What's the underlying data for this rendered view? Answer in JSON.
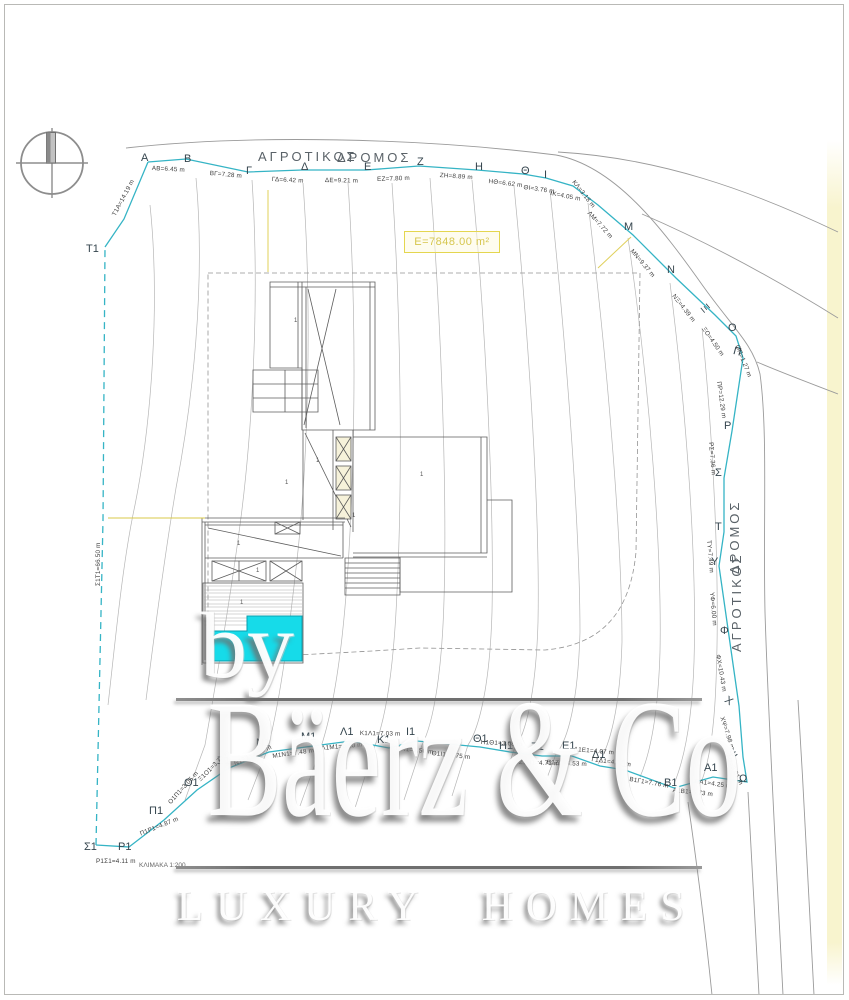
{
  "watermark": {
    "by": "by",
    "brand": "Bäerz & Co",
    "tagline": "LUXURY HOMES"
  },
  "plan": {
    "area_label": "Ε=7848.00 m²",
    "scale_label": "ΚΛΙΜΑΚΑ 1:200",
    "road_top": [
      "ΑΓΡΟΤΙΚΟΣ",
      "ΔΡΟΜΟΣ"
    ],
    "road_right": [
      "ΔΡΟΜΟΣ",
      "ΑΓΡΟΤΙΚΟΣ"
    ],
    "colors": {
      "boundary": "#35b4c5",
      "pool": "#16dbe9",
      "highlight": "#e0d05a",
      "contour": "#b3b3b3"
    },
    "points": [
      {
        "t": "Α",
        "x": 141,
        "y": 152
      },
      {
        "t": "Β",
        "x": 184,
        "y": 153
      },
      {
        "t": "Γ",
        "x": 246,
        "y": 165
      },
      {
        "t": "Δ",
        "x": 301,
        "y": 161
      },
      {
        "t": "Ε",
        "x": 364,
        "y": 161
      },
      {
        "t": "Ζ",
        "x": 417,
        "y": 156
      },
      {
        "t": "Η",
        "x": 475,
        "y": 161
      },
      {
        "t": "Θ",
        "x": 521,
        "y": 165
      },
      {
        "t": "Ι",
        "x": 544,
        "y": 169
      },
      {
        "t": "Μ",
        "x": 624,
        "y": 221
      },
      {
        "t": "Ν",
        "x": 667,
        "y": 264
      },
      {
        "t": "Ξ",
        "x": 707,
        "y": 302,
        "r": 50
      },
      {
        "t": "Ο",
        "x": 728,
        "y": 322
      },
      {
        "t": "Π",
        "x": 735,
        "y": 345,
        "r": 15
      },
      {
        "t": "Ρ",
        "x": 724,
        "y": 420
      },
      {
        "t": "Σ",
        "x": 715,
        "y": 467
      },
      {
        "t": "Τ",
        "x": 715,
        "y": 521
      },
      {
        "t": "Υ",
        "x": 711,
        "y": 556
      },
      {
        "t": "Φ",
        "x": 720,
        "y": 625
      },
      {
        "t": "Χ",
        "x": 729,
        "y": 694,
        "r": 35
      },
      {
        "t": "Ψ",
        "x": 734,
        "y": 747,
        "r": 55
      },
      {
        "t": "Ω",
        "x": 739,
        "y": 773
      },
      {
        "t": "Α1",
        "x": 704,
        "y": 762
      },
      {
        "t": "Β1",
        "x": 664,
        "y": 777
      },
      {
        "t": "Γ1",
        "x": 615,
        "y": 758
      },
      {
        "t": "Δ1",
        "x": 592,
        "y": 749
      },
      {
        "t": "Ε1",
        "x": 562,
        "y": 740
      },
      {
        "t": "Ζ1",
        "x": 531,
        "y": 741
      },
      {
        "t": "Η1",
        "x": 499,
        "y": 740
      },
      {
        "t": "Θ1",
        "x": 473,
        "y": 733
      },
      {
        "t": "Ι1",
        "x": 406,
        "y": 726
      },
      {
        "t": "Κ1",
        "x": 377,
        "y": 734
      },
      {
        "t": "Λ1",
        "x": 340,
        "y": 726
      },
      {
        "t": "Μ1",
        "x": 301,
        "y": 731
      },
      {
        "t": "Ν1",
        "x": 256,
        "y": 737
      },
      {
        "t": "Ξ1",
        "x": 217,
        "y": 755
      },
      {
        "t": "Ο1",
        "x": 184,
        "y": 777
      },
      {
        "t": "Π1",
        "x": 149,
        "y": 805
      },
      {
        "t": "Ρ1",
        "x": 118,
        "y": 841
      },
      {
        "t": "Σ1",
        "x": 84,
        "y": 841
      },
      {
        "t": "Τ1",
        "x": 86,
        "y": 243
      }
    ],
    "measurements": [
      {
        "t": "ΑΒ=6.45 m",
        "x": 152,
        "y": 165,
        "r": 3
      },
      {
        "t": "ΒΓ=7.28 m",
        "x": 210,
        "y": 170,
        "r": 5
      },
      {
        "t": "ΓΔ=6.42 m",
        "x": 272,
        "y": 176,
        "r": 3
      },
      {
        "t": "ΔΕ=9.21 m",
        "x": 325,
        "y": 177,
        "r": 1
      },
      {
        "t": "ΕΖ=7.80 m",
        "x": 377,
        "y": 176,
        "r": -2
      },
      {
        "t": "ΖΗ=8.89 m",
        "x": 440,
        "y": 172,
        "r": 4
      },
      {
        "t": "ΗΘ=6.62 m",
        "x": 489,
        "y": 178,
        "r": 7
      },
      {
        "t": "ΘΙ=3.76 m",
        "x": 524,
        "y": 184,
        "r": 8
      },
      {
        "t": "ΙΚ=4.05 m",
        "x": 551,
        "y": 190,
        "r": 11
      },
      {
        "t": "ΚΛ=3.18 m",
        "x": 576,
        "y": 179,
        "r": 52
      },
      {
        "t": "ΛΜ=7.72 m",
        "x": 591,
        "y": 210,
        "r": 48
      },
      {
        "t": "ΜΝ=9.37 m",
        "x": 634,
        "y": 248,
        "r": 50
      },
      {
        "t": "ΝΞ=4.39 m",
        "x": 676,
        "y": 293,
        "r": 52
      },
      {
        "t": "ΞΟ=4.50 m",
        "x": 706,
        "y": 326,
        "r": 55
      },
      {
        "t": "ΟΠ=1.27 m",
        "x": 740,
        "y": 344,
        "r": 68
      },
      {
        "t": "ΠΡ=12.29 m",
        "x": 722,
        "y": 381,
        "r": 82
      },
      {
        "t": "ΡΣ=7.36 m",
        "x": 714,
        "y": 442,
        "r": 85
      },
      {
        "t": "ΤΥ=7.49 m",
        "x": 712,
        "y": 540,
        "r": 85
      },
      {
        "t": "ΥΦ=6.00 m",
        "x": 715,
        "y": 592,
        "r": 85
      },
      {
        "t": "ΦΧ=10.43 m",
        "x": 721,
        "y": 654,
        "r": 80
      },
      {
        "t": "ΧΨ=7.98 m",
        "x": 725,
        "y": 716,
        "r": 72
      },
      {
        "t": "ΨΩ=3.01 m",
        "x": 729,
        "y": 752,
        "r": 64
      },
      {
        "t": "ΩΑ1=4.25 m",
        "x": 695,
        "y": 778,
        "r": 8
      },
      {
        "t": "Α1Β1=5.73 m",
        "x": 673,
        "y": 787,
        "r": 6
      },
      {
        "t": "Β1Γ1=7.76 m",
        "x": 630,
        "y": 776,
        "r": 10
      },
      {
        "t": "Γ1Δ1=4.02 m",
        "x": 592,
        "y": 756,
        "r": 8
      },
      {
        "t": "Δ1Ε1=4.07 m",
        "x": 574,
        "y": 746,
        "r": 5
      },
      {
        "t": "Ε1Ζ1=4.53 m",
        "x": 547,
        "y": 759,
        "r": 3
      },
      {
        "t": "Ζ1Η1=4.73 m",
        "x": 519,
        "y": 759,
        "r": 2
      },
      {
        "t": "Η1Θ1=3.08 m",
        "x": 481,
        "y": 739,
        "r": 3
      },
      {
        "t": "Θ1Ι1=8.75 m",
        "x": 432,
        "y": 750,
        "r": 6
      },
      {
        "t": "Ι1Κ1=3.50 m",
        "x": 396,
        "y": 745,
        "r": 6
      },
      {
        "t": "Κ1Λ1=7.03 m",
        "x": 360,
        "y": 730,
        "r": 1
      },
      {
        "t": "Λ1Μ1=6.10 m",
        "x": 321,
        "y": 745,
        "r": -5
      },
      {
        "t": "Μ1Ν1=7.48 m",
        "x": 272,
        "y": 753,
        "r": -8
      },
      {
        "t": "Ν1Ξ1=4.08 m",
        "x": 233,
        "y": 761,
        "r": -25
      },
      {
        "t": "Ξ1Ο1=3.74 m",
        "x": 197,
        "y": 778,
        "r": -45
      },
      {
        "t": "Ο1Π1=3.05 m",
        "x": 167,
        "y": 801,
        "r": -48
      },
      {
        "t": "Π1Ρ1=4.87 m",
        "x": 139,
        "y": 831,
        "r": -22
      },
      {
        "t": "Ρ1Σ1=4.11 m",
        "x": 96,
        "y": 858,
        "r": 0
      },
      {
        "t": "Σ1Τ1=66.50 m",
        "x": 95,
        "y": 586,
        "r": -90
      },
      {
        "t": "Τ1Α=14.19 m",
        "x": 111,
        "y": 214,
        "r": -62
      }
    ],
    "marks": [
      {
        "t": "1",
        "x": 294,
        "y": 318
      },
      {
        "t": "1",
        "x": 316,
        "y": 458
      },
      {
        "t": "1",
        "x": 285,
        "y": 480
      },
      {
        "t": "1",
        "x": 237,
        "y": 541
      },
      {
        "t": "1",
        "x": 256,
        "y": 568
      },
      {
        "t": "1",
        "x": 240,
        "y": 600
      },
      {
        "t": "1",
        "x": 352,
        "y": 513
      },
      {
        "t": "1",
        "x": 420,
        "y": 472
      }
    ]
  }
}
